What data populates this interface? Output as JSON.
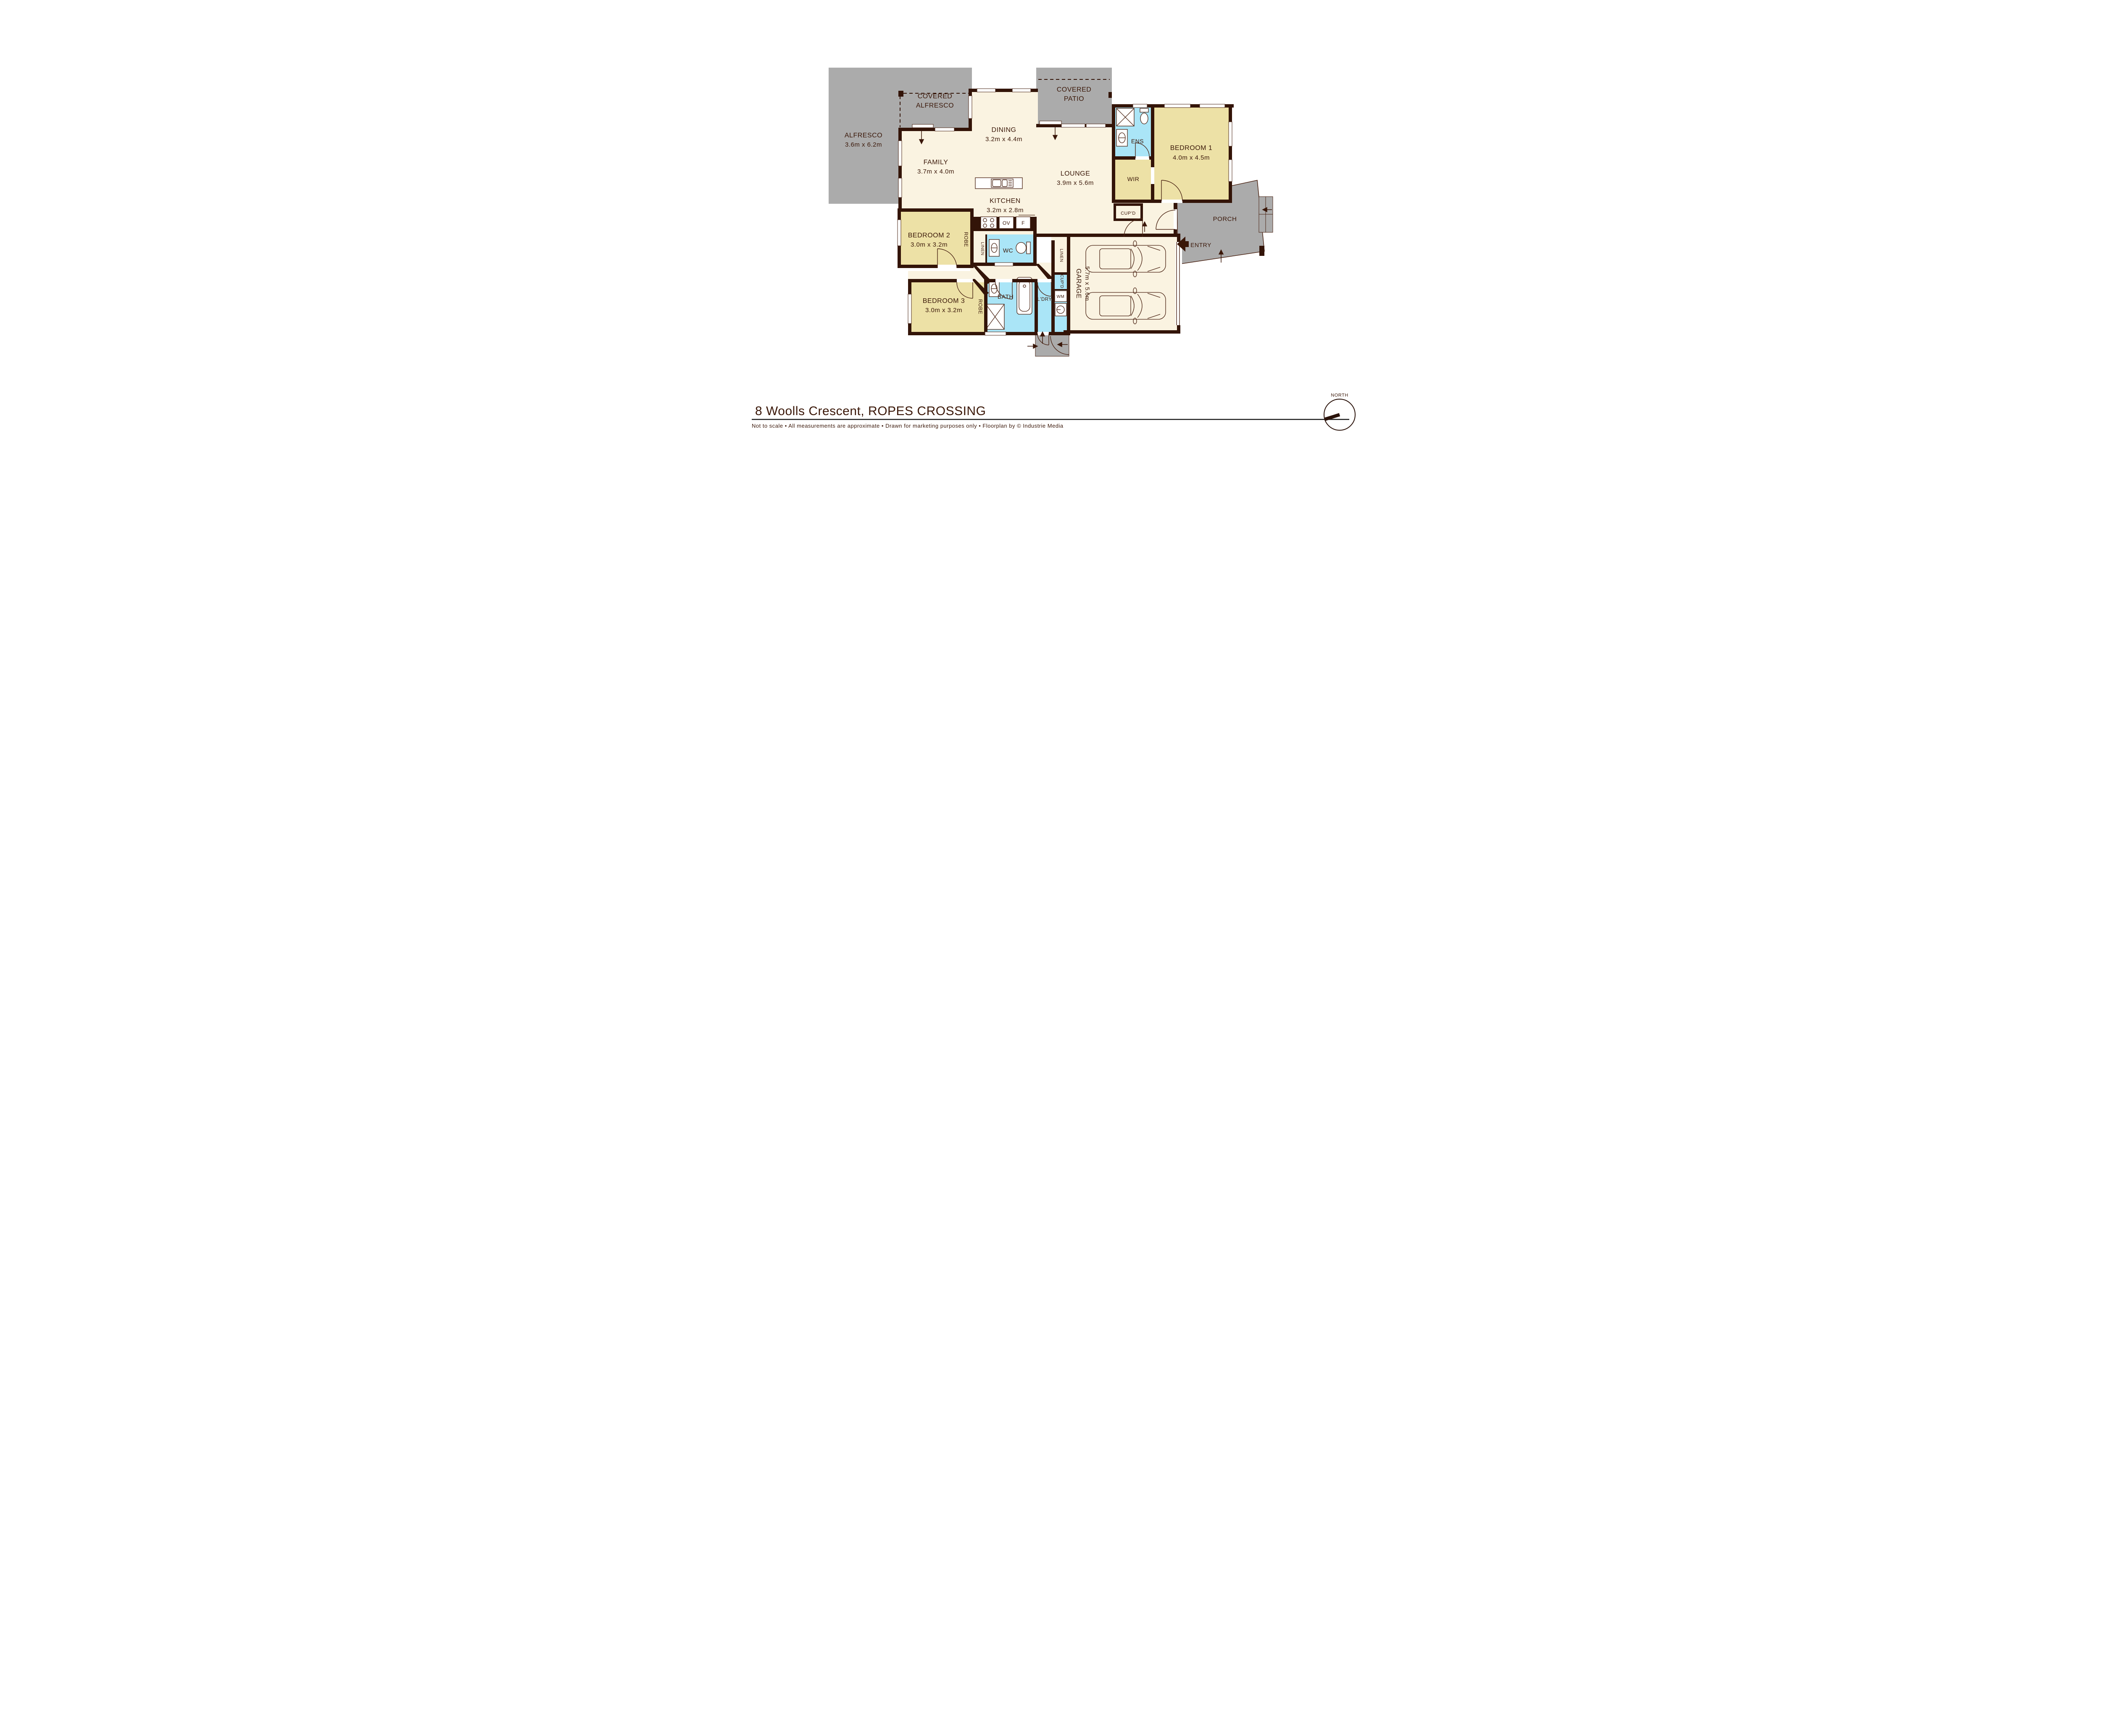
{
  "page": {
    "title": "8 Woolls Crescent, ROPES CROSSING",
    "footer": "Not to scale   •   All measurements are approximate   •   Drawn for marketing purposes only   •   Floorplan by © Industrie Media"
  },
  "compass": {
    "label": "NORTH"
  },
  "colors": {
    "wall": "#331408",
    "floor": "#faf3e1",
    "bedroom": "#ede1a6",
    "wet_area": "#aae5f7",
    "outdoor": "#ababab",
    "label_text": "#3a1708"
  },
  "rooms": {
    "alfresco": {
      "name": "ALFRESCO",
      "dims": "3.6m x 6.2m"
    },
    "covered_alfresco": {
      "line1": "COVERED",
      "line2": "ALFRESCO"
    },
    "covered_patio": {
      "line1": "COVERED",
      "line2": "PATIO"
    },
    "dining": {
      "name": "DINING",
      "dims": "3.2m x 4.4m"
    },
    "family": {
      "name": "FAMILY",
      "dims": "3.7m x 4.0m"
    },
    "lounge": {
      "name": "LOUNGE",
      "dims": "3.9m x 5.6m"
    },
    "kitchen": {
      "name": "KITCHEN",
      "dims": "3.2m x 2.8m"
    },
    "bedroom1": {
      "name": "BEDROOM 1",
      "dims": "4.0m x 4.5m"
    },
    "bedroom2": {
      "name": "BEDROOM 2",
      "dims": "3.0m x 3.2m"
    },
    "bedroom3": {
      "name": "BEDROOM 3",
      "dims": "3.0m x 3.2m"
    },
    "garage": {
      "name": "GARAGE",
      "dims": "5.7m x 5.6m"
    },
    "ens": {
      "name": "ENS"
    },
    "wir": {
      "name": "WIR"
    },
    "wc": {
      "name": "WC"
    },
    "bath": {
      "name": "BATH"
    },
    "laundry": {
      "name": "L'DRY"
    },
    "porch": {
      "name": "PORCH"
    },
    "entry": {
      "name": "ENTRY"
    },
    "cupboard_hall": {
      "name": "CUP'D"
    },
    "cupboard_laundry": {
      "name": "CUP'D"
    },
    "robe_bed2": {
      "name": "ROBE"
    },
    "robe_bed3": {
      "name": "ROBE"
    },
    "linen_hall": {
      "name": "LINEN"
    },
    "linen_garage": {
      "name": "LINEN"
    },
    "washing_machine": {
      "name": "WM"
    },
    "oven": {
      "name": "OV"
    },
    "fridge": {
      "name": "F"
    }
  }
}
